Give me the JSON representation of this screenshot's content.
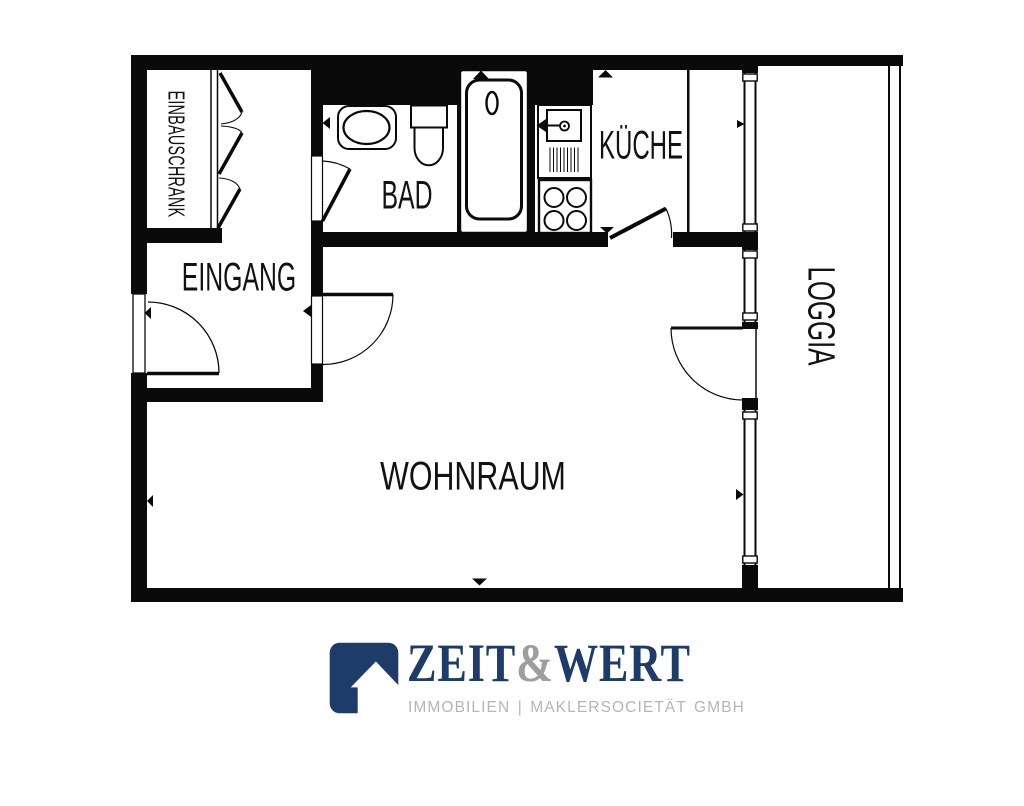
{
  "floorplan": {
    "rooms": {
      "einbauschrank": "EINBAUSCHRANK",
      "bad": "BAD",
      "kueche": "KÜCHE",
      "eingang": "EINGANG",
      "wohnraum": "WOHNRAUM",
      "loggia": "LOGGIA"
    },
    "line_color": "#0a0a0a",
    "fixture_icons": [
      "bathtub-icon",
      "toilet-icon",
      "washbasin-icon",
      "kitchen-sink-icon",
      "stove-icon",
      "wardrobe-folding-doors-icon",
      "window-icon",
      "door-swing-icon",
      "marker-triangle-icon"
    ]
  },
  "branding": {
    "icon": "house-arrow-icon",
    "word_zeit": "ZEIT",
    "word_amp": "&",
    "word_wert": "WERT",
    "tagline": "IMMOBILIEN | MAKLERSOCIETÄT GMBH",
    "color_navy": "#1e3c69",
    "color_amp": "#9e9e9e",
    "color_tagline": "#b5b5b5"
  }
}
